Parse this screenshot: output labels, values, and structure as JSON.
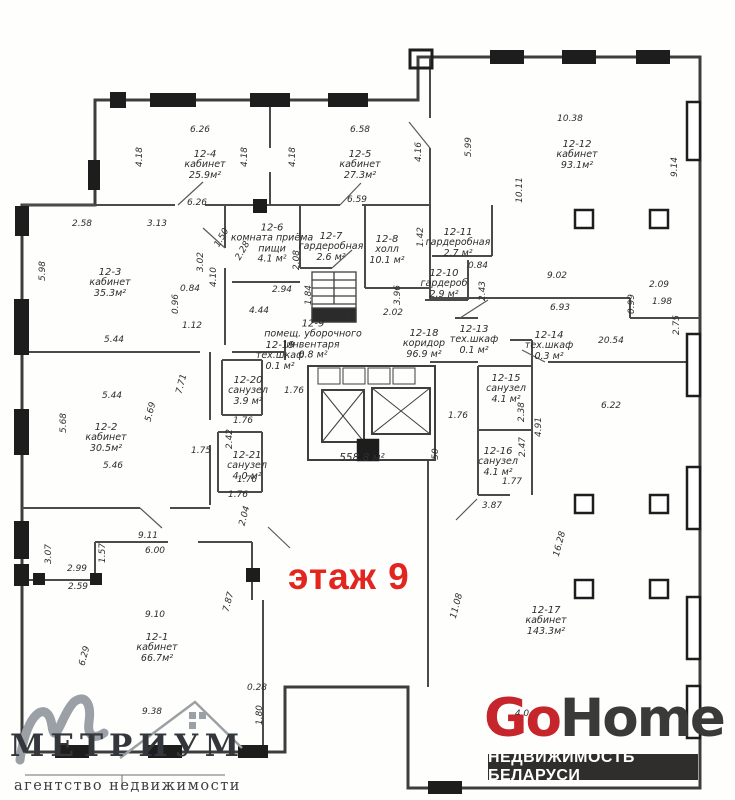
{
  "floor_label": {
    "text": "этаж 9",
    "color": "#e2251f"
  },
  "total_area": "558.8 м²",
  "rooms": [
    {
      "id": "12-1",
      "name": "кабинет",
      "area": "66.7м²",
      "x": 157,
      "y": 648
    },
    {
      "id": "12-2",
      "name": "кабинет",
      "area": "30.5м²",
      "x": 106,
      "y": 438
    },
    {
      "id": "12-3",
      "name": "кабинет",
      "area": "35.3м²",
      "x": 110,
      "y": 283
    },
    {
      "id": "12-4",
      "name": "кабинет",
      "area": "25.9м²",
      "x": 205,
      "y": 165
    },
    {
      "id": "12-5",
      "name": "кабинет",
      "area": "27.3м²",
      "x": 360,
      "y": 165
    },
    {
      "id": "12-6",
      "name": "комната приёма пищи",
      "area": "4.1 м²",
      "x": 272,
      "y": 244,
      "w": 104
    },
    {
      "id": "12-7",
      "name": "гардеробная",
      "area": "2.6 м²",
      "x": 331,
      "y": 247,
      "w": 82
    },
    {
      "id": "12-8",
      "name": "холл",
      "area": "10.1 м²",
      "x": 387,
      "y": 250
    },
    {
      "id": "12-9",
      "name": "помещ. уборочного инвентаря",
      "area": "0.8 м²",
      "x": 313,
      "y": 340,
      "w": 108
    },
    {
      "id": "12-10",
      "name": "гардероб",
      "area": "2.9 м²",
      "x": 444,
      "y": 284,
      "w": 72
    },
    {
      "id": "12-11",
      "name": "гардеробная",
      "area": "2.7 м²",
      "x": 458,
      "y": 243,
      "w": 80
    },
    {
      "id": "12-12",
      "name": "кабинет",
      "area": "93.1м²",
      "x": 577,
      "y": 155
    },
    {
      "id": "12-13",
      "name": "тех.шкаф",
      "area": "0.1 м²",
      "x": 474,
      "y": 340
    },
    {
      "id": "12-14",
      "name": "тех.шкаф",
      "area": "0.3 м²",
      "x": 549,
      "y": 346
    },
    {
      "id": "12-15",
      "name": "санузел",
      "area": "4.1 м²",
      "x": 506,
      "y": 389
    },
    {
      "id": "12-16",
      "name": "санузел",
      "area": "4.1 м²",
      "x": 498,
      "y": 462
    },
    {
      "id": "12-17",
      "name": "кабинет",
      "area": "143.3м²",
      "x": 546,
      "y": 621
    },
    {
      "id": "12-18",
      "name": "коридор",
      "area": "96.9 м²",
      "x": 424,
      "y": 344
    },
    {
      "id": "12-19",
      "name": "тех.шкаф",
      "area": "0.1 м²",
      "x": 280,
      "y": 356
    },
    {
      "id": "12-20",
      "name": "санузел",
      "area": "3.9 м²",
      "x": 248,
      "y": 391
    },
    {
      "id": "12-21",
      "name": "санузел",
      "area": "4.0 м²",
      "x": 247,
      "y": 466
    }
  ],
  "dimensions": [
    {
      "t": "6.26",
      "x": 200,
      "y": 130,
      "r": 0
    },
    {
      "t": "4.18",
      "x": 140,
      "y": 157,
      "r": -90
    },
    {
      "t": "4.18",
      "x": 245,
      "y": 157,
      "r": -90
    },
    {
      "t": "4.18",
      "x": 293,
      "y": 157,
      "r": -90
    },
    {
      "t": "6.58",
      "x": 360,
      "y": 130,
      "r": 0
    },
    {
      "t": "4.16",
      "x": 419,
      "y": 152,
      "r": -90
    },
    {
      "t": "5.99",
      "x": 469,
      "y": 147,
      "r": -90
    },
    {
      "t": "10.38",
      "x": 570,
      "y": 119,
      "r": 0
    },
    {
      "t": "10.11",
      "x": 520,
      "y": 190,
      "r": -90
    },
    {
      "t": "9.14",
      "x": 675,
      "y": 167,
      "r": -90
    },
    {
      "t": "6.26",
      "x": 197,
      "y": 203,
      "r": 0
    },
    {
      "t": "6.59",
      "x": 357,
      "y": 200,
      "r": 0
    },
    {
      "t": "2.58",
      "x": 82,
      "y": 224,
      "r": 0
    },
    {
      "t": "3.13",
      "x": 157,
      "y": 224,
      "r": 0
    },
    {
      "t": "1.50",
      "x": 222,
      "y": 238,
      "r": -60
    },
    {
      "t": "2.28",
      "x": 243,
      "y": 251,
      "r": -60
    },
    {
      "t": "5.98",
      "x": 43,
      "y": 271,
      "r": -90
    },
    {
      "t": "3.02",
      "x": 201,
      "y": 262,
      "r": -90
    },
    {
      "t": "4.10",
      "x": 214,
      "y": 277,
      "r": -90
    },
    {
      "t": "0.84",
      "x": 190,
      "y": 289,
      "r": 0
    },
    {
      "t": "0.96",
      "x": 176,
      "y": 304,
      "r": -90
    },
    {
      "t": "1.12",
      "x": 192,
      "y": 326,
      "r": 0
    },
    {
      "t": "5.44",
      "x": 114,
      "y": 340,
      "r": 0
    },
    {
      "t": "2.08",
      "x": 297,
      "y": 260,
      "r": -90
    },
    {
      "t": "2.94",
      "x": 282,
      "y": 290,
      "r": 0
    },
    {
      "t": "1.84",
      "x": 309,
      "y": 295,
      "r": -90
    },
    {
      "t": "4.44",
      "x": 259,
      "y": 311,
      "r": 0
    },
    {
      "t": "1.43",
      "x": 346,
      "y": 319,
      "r": 0
    },
    {
      "t": "3.96",
      "x": 398,
      "y": 295,
      "r": -90
    },
    {
      "t": "2.02",
      "x": 393,
      "y": 313,
      "r": 0
    },
    {
      "t": "1.42",
      "x": 421,
      "y": 237,
      "r": -90
    },
    {
      "t": "0.84",
      "x": 478,
      "y": 266,
      "r": 0
    },
    {
      "t": "2.43",
      "x": 483,
      "y": 291,
      "r": -90
    },
    {
      "t": "9.02",
      "x": 557,
      "y": 276,
      "r": 0
    },
    {
      "t": "6.93",
      "x": 560,
      "y": 308,
      "r": 0
    },
    {
      "t": "0.99",
      "x": 632,
      "y": 304,
      "r": -90
    },
    {
      "t": "2.09",
      "x": 659,
      "y": 285,
      "r": 0
    },
    {
      "t": "1.98",
      "x": 662,
      "y": 302,
      "r": 0
    },
    {
      "t": "2.75",
      "x": 677,
      "y": 325,
      "r": -90
    },
    {
      "t": "20.54",
      "x": 611,
      "y": 341,
      "r": 0
    },
    {
      "t": "6.22",
      "x": 611,
      "y": 406,
      "r": 0
    },
    {
      "t": "1.76",
      "x": 294,
      "y": 391,
      "r": 0
    },
    {
      "t": "1.76",
      "x": 458,
      "y": 416,
      "r": 0
    },
    {
      "t": "2.38",
      "x": 522,
      "y": 412,
      "r": -90
    },
    {
      "t": "4.91",
      "x": 539,
      "y": 427,
      "r": -90
    },
    {
      "t": "2.47",
      "x": 523,
      "y": 447,
      "r": -90
    },
    {
      "t": "1.77",
      "x": 512,
      "y": 482,
      "r": 0
    },
    {
      "t": "3.87",
      "x": 492,
      "y": 506,
      "r": 0
    },
    {
      "t": "7.71",
      "x": 182,
      "y": 384,
      "r": -75
    },
    {
      "t": "5.69",
      "x": 151,
      "y": 412,
      "r": -75
    },
    {
      "t": "5.68",
      "x": 64,
      "y": 423,
      "r": -90
    },
    {
      "t": "5.44",
      "x": 112,
      "y": 396,
      "r": 0
    },
    {
      "t": "5.46",
      "x": 113,
      "y": 466,
      "r": 0
    },
    {
      "t": "1.75",
      "x": 201,
      "y": 451,
      "r": 0
    },
    {
      "t": "2.42",
      "x": 230,
      "y": 439,
      "r": -90
    },
    {
      "t": "1.76",
      "x": 243,
      "y": 421,
      "r": 0
    },
    {
      "t": "1.76",
      "x": 247,
      "y": 480,
      "r": 0
    },
    {
      "t": "1.76",
      "x": 238,
      "y": 495,
      "r": 0
    },
    {
      "t": "2.04",
      "x": 245,
      "y": 516,
      "r": -75
    },
    {
      "t": "9.11",
      "x": 148,
      "y": 536,
      "r": 0
    },
    {
      "t": "6.00",
      "x": 155,
      "y": 551,
      "r": 0
    },
    {
      "t": "1.57",
      "x": 103,
      "y": 553,
      "r": -90
    },
    {
      "t": "3.07",
      "x": 49,
      "y": 554,
      "r": -90
    },
    {
      "t": "2.99",
      "x": 77,
      "y": 569,
      "r": 0
    },
    {
      "t": "2.59",
      "x": 78,
      "y": 587,
      "r": 0
    },
    {
      "t": "9.10",
      "x": 155,
      "y": 615,
      "r": 0
    },
    {
      "t": "6.29",
      "x": 85,
      "y": 656,
      "r": -75
    },
    {
      "t": "7.87",
      "x": 229,
      "y": 602,
      "r": -75
    },
    {
      "t": "11.08",
      "x": 457,
      "y": 606,
      "r": -75
    },
    {
      "t": "16.28",
      "x": 560,
      "y": 544,
      "r": -75
    },
    {
      "t": "0.28",
      "x": 257,
      "y": 688,
      "r": 0
    },
    {
      "t": "1.80",
      "x": 260,
      "y": 715,
      "r": -90
    },
    {
      "t": "9.38",
      "x": 152,
      "y": 712,
      "r": 0
    },
    {
      "t": "4.0",
      "x": 522,
      "y": 714,
      "r": 0
    },
    {
      "t": "50",
      "x": 436,
      "y": 454,
      "r": -90
    }
  ],
  "logos": {
    "metrium": {
      "title": "МЕТРИУМ",
      "tagline": "агентство недвижимости",
      "swash_color": "#9aa0a6",
      "text_color": "#33373c"
    },
    "gohome": {
      "go": "Go",
      "home": "Home",
      "tagline": "НЕДВИЖИМОСТЬ БЕЛАРУСИ",
      "accent": "#c6252b",
      "dark": "#3a3a38",
      "bar": "#2f2e2c"
    }
  }
}
